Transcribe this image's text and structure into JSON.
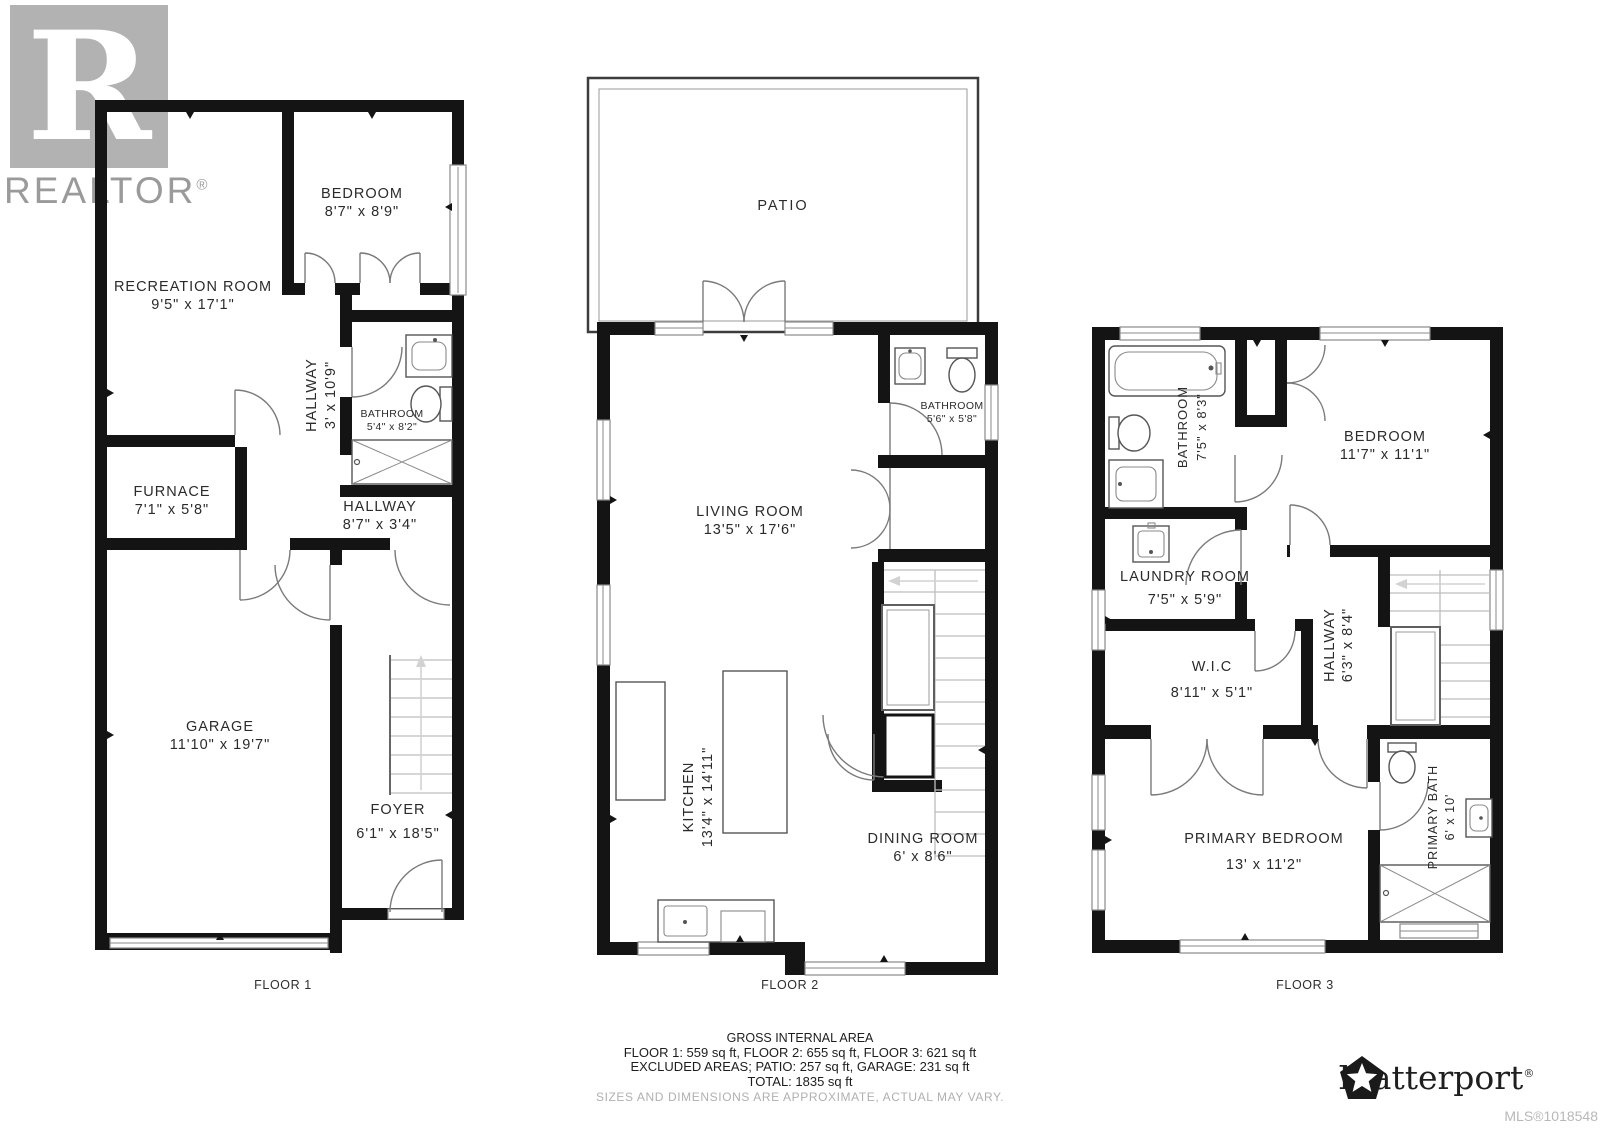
{
  "branding": {
    "realtor_logo_letter": "R",
    "realtor_text": "REALTOR",
    "registered_symbol": "®",
    "matterport_text": "Matterport",
    "mls_label": "MLS®1018548"
  },
  "floors": [
    {
      "label": "FLOOR 1",
      "rooms": [
        {
          "name": "RECREATION ROOM",
          "dims": "9'5\" x 17'1\""
        },
        {
          "name": "BEDROOM",
          "dims": "8'7\" x 8'9\""
        },
        {
          "name": "HALLWAY",
          "dims": "3' x 10'9\""
        },
        {
          "name": "BATHROOM",
          "dims": "5'4\" x 8'2\""
        },
        {
          "name": "FURNACE",
          "dims": "7'1\" x 5'8\""
        },
        {
          "name": "HALLWAY",
          "dims": "8'7\" x 3'4\""
        },
        {
          "name": "GARAGE",
          "dims": "11'10\" x 19'7\""
        },
        {
          "name": "FOYER",
          "dims": "6'1\" x 18'5\""
        }
      ]
    },
    {
      "label": "FLOOR 2",
      "rooms": [
        {
          "name": "PATIO",
          "dims": ""
        },
        {
          "name": "BATHROOM",
          "dims": "5'6\" x 5'8\""
        },
        {
          "name": "LIVING ROOM",
          "dims": "13'5\" x 17'6\""
        },
        {
          "name": "KITCHEN",
          "dims": "13'4\" x 14'11\""
        },
        {
          "name": "DINING ROOM",
          "dims": "6' x 8'6\""
        }
      ]
    },
    {
      "label": "FLOOR 3",
      "rooms": [
        {
          "name": "BATHROOM",
          "dims": "7'5\" x 8'3\""
        },
        {
          "name": "BEDROOM",
          "dims": "11'7\" x 11'1\""
        },
        {
          "name": "LAUNDRY ROOM",
          "dims": "7'5\" x 5'9\""
        },
        {
          "name": "W.I.C",
          "dims": "8'11\" x 5'1\""
        },
        {
          "name": "HALLWAY",
          "dims": "6'3\" x 8'4\""
        },
        {
          "name": "PRIMARY BEDROOM",
          "dims": "13' x 11'2\""
        },
        {
          "name": "PRIMARY BATH",
          "dims": "6' x 10'"
        }
      ]
    }
  ],
  "summary": {
    "title": "GROSS INTERNAL AREA",
    "floor_areas": "FLOOR 1: 559 sq ft, FLOOR 2: 655 sq ft, FLOOR 3: 621 sq ft",
    "excluded_areas": "EXCLUDED AREAS; PATIO: 257 sq ft, GARAGE: 231 sq ft",
    "total": "TOTAL: 1835 sq ft",
    "disclaimer": "SIZES AND DIMENSIONS ARE APPROXIMATE, ACTUAL MAY VARY."
  }
}
